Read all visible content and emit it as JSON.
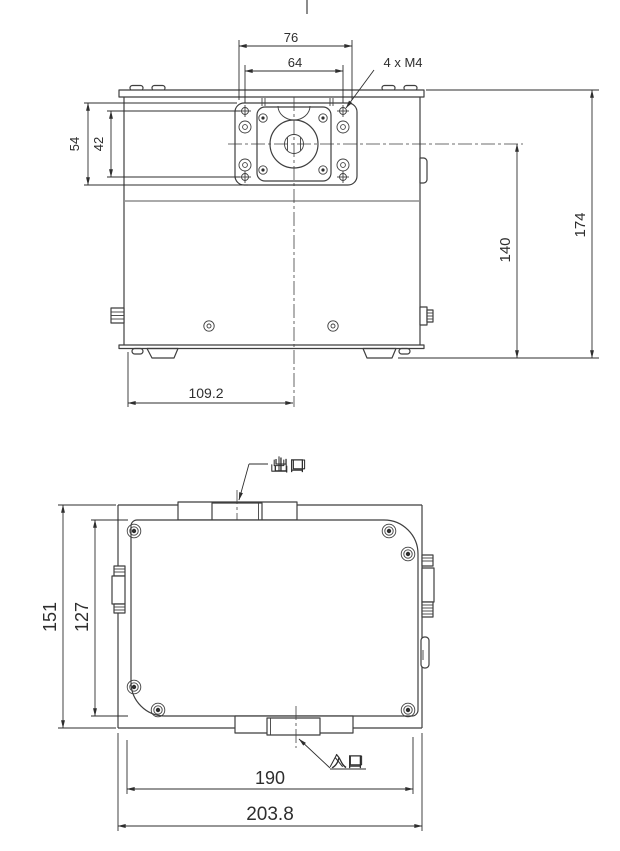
{
  "drawing": {
    "description": "two-view mechanical outline drawing of a pump unit with motor mounting plate",
    "colors": {
      "background": "#ffffff",
      "line": "#3f3f3f",
      "dimension": "#2e2e2e",
      "light_line": "#8d8d8d"
    },
    "front_view": {
      "dim_top_outer": "76",
      "dim_top_inner": "64",
      "thread_callout": "4 x M4",
      "dim_left_outer": "54",
      "dim_left_inner": "42",
      "dim_right_inner": "140",
      "dim_right_outer": "174",
      "dim_bottom": "109.2"
    },
    "top_view": {
      "dim_left_outer": "151",
      "dim_left_inner": "127",
      "dim_bottom_inner": "190",
      "dim_bottom_outer": "203.8",
      "outlet_label": "出口",
      "inlet_label": "入口"
    }
  }
}
